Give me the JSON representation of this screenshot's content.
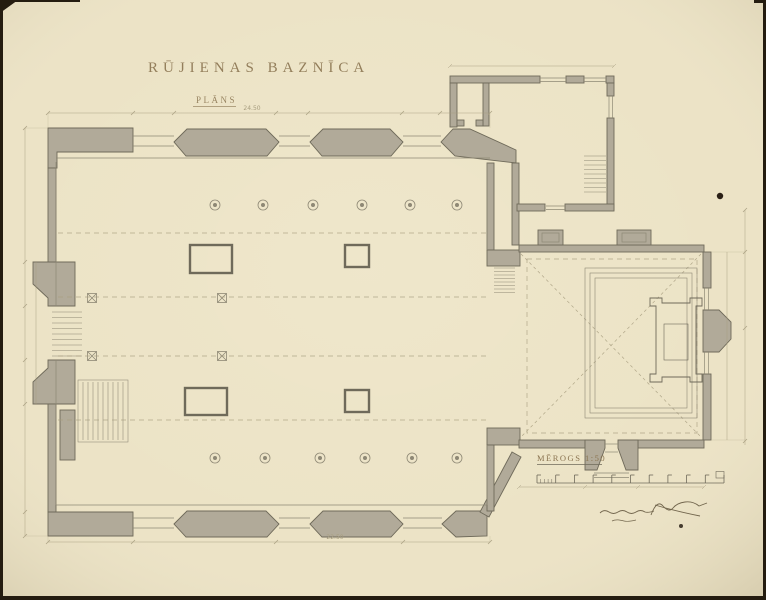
{
  "paper": {
    "background": "#ece3c6",
    "edge_color": "#241c10"
  },
  "ink": {
    "line": "#6f6a5a",
    "thin": "#8e8875",
    "faint": "#a79d7f",
    "title": "#8a7450",
    "signature": "#5e5139",
    "wall_fill": "#b1aa99"
  },
  "title": {
    "text": "RŪJIENAS BAZNĪCA"
  },
  "subtitle": {
    "text": "PLĀNS"
  },
  "scale": {
    "label": "MĒROGS 1:50"
  },
  "dimensions": {
    "top_overall": "24.50",
    "bottom_overall": "22.50"
  }
}
